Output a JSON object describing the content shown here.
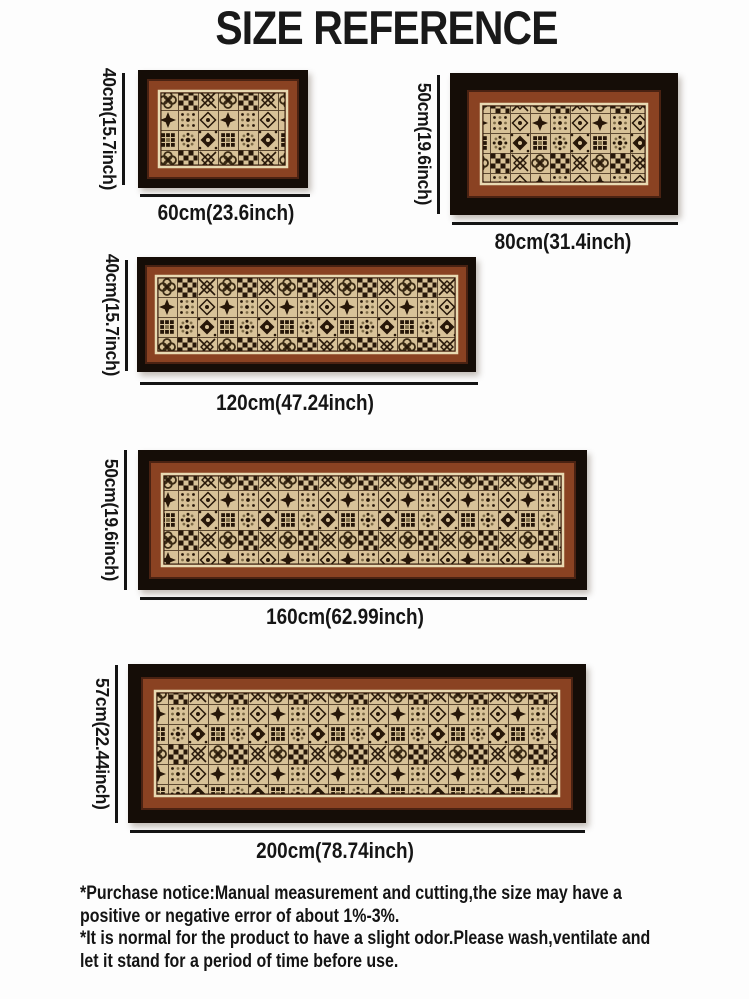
{
  "title": "SIZE REFERENCE",
  "rugs": [
    {
      "name": "rug-60x40",
      "height_label": "40cm(15.7inch)",
      "width_label": "60cm(23.6inch)"
    },
    {
      "name": "rug-80x50",
      "height_label": "50cm(19.6inch)",
      "width_label": "80cm(31.4inch)"
    },
    {
      "name": "rug-120x40",
      "height_label": "40cm(15.7inch)",
      "width_label": "120cm(47.24inch)"
    },
    {
      "name": "rug-160x50",
      "height_label": "50cm(19.6inch)",
      "width_label": "160cm(62.99inch)"
    },
    {
      "name": "rug-200x57",
      "height_label": "57cm(22.44inch)",
      "width_label": "200cm(78.74inch)"
    }
  ],
  "footer": {
    "lines": [
      "*Purchase notice:Manual measurement and cutting,the size may have a",
      "positive or negative error of about 1%-3%.",
      "*It is normal for the product to have a slight odor.Please wash,ventilate and",
      "let it stand for a period of time before use."
    ]
  },
  "colors": {
    "background": "#fdfdfd",
    "text": "#161616",
    "dimension_line": "#141414",
    "rug_outer_border": "#150d07",
    "rug_inner_border": "#8a4222",
    "rug_pinstripe": "#e8d9b2",
    "rug_field": "#d8c298",
    "rug_motif": "#271709",
    "rug_accent": "#7d6b47"
  }
}
